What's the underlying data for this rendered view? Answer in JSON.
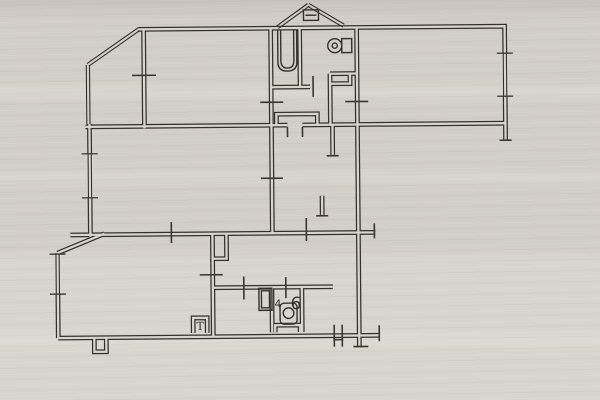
{
  "document": {
    "kind": "scanned floor plan sheet",
    "paper_color": "#d8d4ce",
    "ink_color": "#34312c",
    "tick_color": "#3a3731"
  },
  "plan": {
    "rotation_deg": -0.5,
    "wall_outer_width": 4.8,
    "wall_inner_width": 2.3,
    "walls": [
      {
        "name": "wall-top-and-right-outer",
        "pts": [
          [
            139,
            28
          ],
          [
            506,
            28
          ],
          [
            506,
            142
          ]
        ]
      },
      {
        "name": "wall-bay-divider",
        "pts": [
          [
            145,
            28
          ],
          [
            145,
            127
          ]
        ]
      },
      {
        "name": "wall-left-upper",
        "pts": [
          [
            90,
            122
          ],
          [
            90,
            235
          ]
        ]
      },
      {
        "name": "wall-mid-horizontal-left",
        "pts": [
          [
            86,
            125
          ],
          [
            288,
            125
          ]
        ]
      },
      {
        "name": "wall-mid-horizontal-right",
        "pts": [
          [
            303,
            125
          ],
          [
            506,
            125
          ]
        ]
      },
      {
        "name": "wall-strip-top",
        "pts": [
          [
            70,
            233
          ],
          [
            375,
            233
          ]
        ]
      },
      {
        "name": "wall-lower-slant",
        "pts": [
          [
            57,
            251
          ],
          [
            104,
            232
          ]
        ]
      },
      {
        "name": "wall-left-lower",
        "pts": [
          [
            57,
            251
          ],
          [
            57,
            336
          ]
        ]
      },
      {
        "name": "wall-bottom",
        "pts": [
          [
            57,
            336
          ],
          [
            378,
            336
          ]
        ]
      },
      {
        "name": "wall-bottom-notch",
        "pts": [
          [
            93,
            336
          ],
          [
            93,
            350
          ],
          [
            105,
            350
          ],
          [
            105,
            336
          ]
        ]
      },
      {
        "name": "wall-right-main",
        "pts": [
          [
            358,
            28
          ],
          [
            358,
            348
          ]
        ]
      },
      {
        "name": "wall-bath-left",
        "pts": [
          [
            272,
            28
          ],
          [
            272,
            233
          ]
        ]
      },
      {
        "name": "wall-bath-right",
        "pts": [
          [
            301,
            28
          ],
          [
            301,
            87
          ]
        ]
      },
      {
        "name": "wall-bath-bottom",
        "pts": [
          [
            272,
            87
          ],
          [
            311,
            87
          ]
        ]
      },
      {
        "name": "wall-wc-bottom",
        "pts": [
          [
            331,
            74
          ],
          [
            358,
            74
          ]
        ]
      },
      {
        "name": "wall-hall-divider",
        "pts": [
          [
            331,
            74
          ],
          [
            331,
            125
          ]
        ]
      },
      {
        "name": "closet-hallway",
        "pts": [
          [
            277,
            125
          ],
          [
            277,
            114
          ],
          [
            318,
            114
          ],
          [
            318,
            125
          ]
        ]
      },
      {
        "name": "wall-stub-upper",
        "pts": [
          [
            333,
            125
          ],
          [
            333,
            155
          ]
        ]
      },
      {
        "name": "wall-stub-lower",
        "pts": [
          [
            322,
            196
          ],
          [
            322,
            215
          ]
        ]
      },
      {
        "name": "vent-shaft",
        "pts": [
          [
            212,
            233
          ],
          [
            212,
            258
          ],
          [
            226,
            258
          ],
          [
            226,
            233
          ]
        ]
      },
      {
        "name": "wall-kitchen-left",
        "pts": [
          [
            212,
            258
          ],
          [
            212,
            336
          ]
        ]
      },
      {
        "name": "wall-kitchen-top",
        "pts": [
          [
            211,
            287
          ],
          [
            332,
            287
          ]
        ]
      },
      {
        "name": "wall-cabin-left",
        "pts": [
          [
            271,
            287
          ],
          [
            271,
            332
          ]
        ]
      },
      {
        "name": "wall-cabin-right",
        "pts": [
          [
            301,
            287
          ],
          [
            301,
            332
          ]
        ]
      },
      {
        "name": "cabin-plinth",
        "pts": [
          [
            274,
            332
          ],
          [
            274,
            325
          ],
          [
            299,
            325
          ],
          [
            299,
            332
          ]
        ]
      },
      {
        "name": "wc-shelf",
        "pts": [
          [
            331,
            84
          ],
          [
            351,
            84
          ],
          [
            351,
            74
          ]
        ]
      },
      {
        "name": "t-box",
        "pts": [
          [
            192,
            332
          ],
          [
            192,
            317
          ],
          [
            206,
            317
          ],
          [
            206,
            332
          ]
        ]
      }
    ],
    "glazing": [
      {
        "name": "bay-slant-window",
        "x1": 89,
        "y1": 63,
        "x2": 140,
        "y2": 28
      },
      {
        "name": "bay-left-window",
        "x1": 89,
        "y1": 63,
        "x2": 89,
        "y2": 122
      },
      {
        "name": "peak-window-left",
        "x1": 279,
        "y1": 27,
        "x2": 310,
        "y2": 5
      },
      {
        "name": "peak-window-right",
        "x1": 310,
        "y1": 5,
        "x2": 345,
        "y2": 26
      }
    ],
    "windows": [
      {
        "name": "window-living-left",
        "x": 90,
        "y1": 152,
        "y2": 196
      },
      {
        "name": "window-lower-left",
        "x": 57,
        "y1": 252,
        "y2": 292
      },
      {
        "name": "window-right-room",
        "x": 506,
        "y1": 55,
        "y2": 98
      }
    ],
    "ticks": [
      {
        "name": "door-tick",
        "x1": 133,
        "y1": 74,
        "x2": 157,
        "y2": 74
      },
      {
        "name": "door-tick",
        "x1": 314,
        "y1": 76,
        "x2": 314,
        "y2": 97
      },
      {
        "name": "door-tick",
        "x1": 261,
        "y1": 102,
        "x2": 284,
        "y2": 102
      },
      {
        "name": "door-tick",
        "x1": 346,
        "y1": 102,
        "x2": 369,
        "y2": 102
      },
      {
        "name": "door-tick",
        "x1": 261,
        "y1": 178,
        "x2": 283,
        "y2": 178
      },
      {
        "name": "door-tick",
        "x1": 171,
        "y1": 221,
        "x2": 171,
        "y2": 242
      },
      {
        "name": "door-tick",
        "x1": 306,
        "y1": 218,
        "x2": 306,
        "y2": 241
      },
      {
        "name": "door-tick",
        "x1": 285,
        "y1": 277,
        "x2": 285,
        "y2": 298
      },
      {
        "name": "door-tick",
        "x1": 243,
        "y1": 276,
        "x2": 243,
        "y2": 299
      },
      {
        "name": "door-tick",
        "x1": 199,
        "y1": 274,
        "x2": 222,
        "y2": 274
      },
      {
        "name": "entrance-tick",
        "x1": 333,
        "y1": 325,
        "x2": 333,
        "y2": 347
      },
      {
        "name": "entrance-tick",
        "x1": 341,
        "y1": 325,
        "x2": 341,
        "y2": 347
      },
      {
        "name": "threshold-line",
        "x1": 332,
        "y1": 340,
        "x2": 342,
        "y2": 340
      },
      {
        "name": "wall-end-tick",
        "x1": 374,
        "y1": 224,
        "x2": 374,
        "y2": 239
      },
      {
        "name": "wall-end-tick",
        "x1": 378,
        "y1": 326,
        "x2": 378,
        "y2": 342
      },
      {
        "name": "wall-end-tick",
        "x1": 352,
        "y1": 347,
        "x2": 367,
        "y2": 347
      },
      {
        "name": "wall-end-tick",
        "x1": 500,
        "y1": 142,
        "x2": 512,
        "y2": 142
      },
      {
        "name": "wall-end-tick",
        "x1": 327,
        "y1": 156,
        "x2": 339,
        "y2": 156
      },
      {
        "name": "wall-end-tick",
        "x1": 316,
        "y1": 216,
        "x2": 328,
        "y2": 216
      },
      {
        "name": "door-jamb",
        "x1": 288,
        "y1": 127,
        "x2": 288,
        "y2": 137
      },
      {
        "name": "door-jamb",
        "x1": 303,
        "y1": 127,
        "x2": 303,
        "y2": 137
      }
    ],
    "fixtures": [
      {
        "name": "bathtub-outline",
        "type": "path",
        "d": "M279,30 L279,62 Q279,71 288.5,71 Q298,71 298,62 L298,30"
      },
      {
        "name": "bathtub-inner",
        "type": "path",
        "d": "M282,30 L282,60.5 Q282,68 288.5,68 Q295,68 295,60.5 L295,30"
      },
      {
        "name": "toilet-tank",
        "type": "rect",
        "x": 343,
        "y": 39,
        "w": 10,
        "h": 14
      },
      {
        "name": "toilet-bowl",
        "type": "circle",
        "cx": 336,
        "cy": 46,
        "r": 7
      },
      {
        "name": "toilet-drain",
        "type": "circle",
        "cx": 336,
        "cy": 46,
        "r": 2.6
      },
      {
        "name": "toilet2-tank",
        "type": "rect",
        "x": 279,
        "y": 303,
        "w": 17,
        "h": 21,
        "rx": 4
      },
      {
        "name": "toilet2-bowl",
        "type": "circle",
        "cx": 287.5,
        "cy": 313,
        "r": 5.3
      },
      {
        "name": "kitchen-sink",
        "type": "rect",
        "x": 258,
        "y": 288,
        "w": 13,
        "h": 22
      },
      {
        "name": "kitchen-sink-inner",
        "type": "rect",
        "x": 260.5,
        "y": 290.5,
        "w": 8,
        "h": 17
      },
      {
        "name": "roof-vent-box",
        "type": "rect",
        "x": 305,
        "y": 10,
        "w": 15,
        "h": 10.5
      },
      {
        "name": "roof-vent-line",
        "type": "line",
        "x1": 307,
        "y1": 15.3,
        "x2": 318,
        "y2": 15.3
      }
    ],
    "labels": [
      {
        "name": "label-room-6",
        "text": "6",
        "x": 295,
        "y": 309,
        "size": 17,
        "serif": false
      },
      {
        "name": "label-room-4",
        "text": "4",
        "x": 277,
        "y": 307,
        "size": 10.5,
        "serif": false
      },
      {
        "name": "label-t",
        "text": "T",
        "x": 199,
        "y": 329,
        "size": 11,
        "serif": true
      }
    ]
  }
}
